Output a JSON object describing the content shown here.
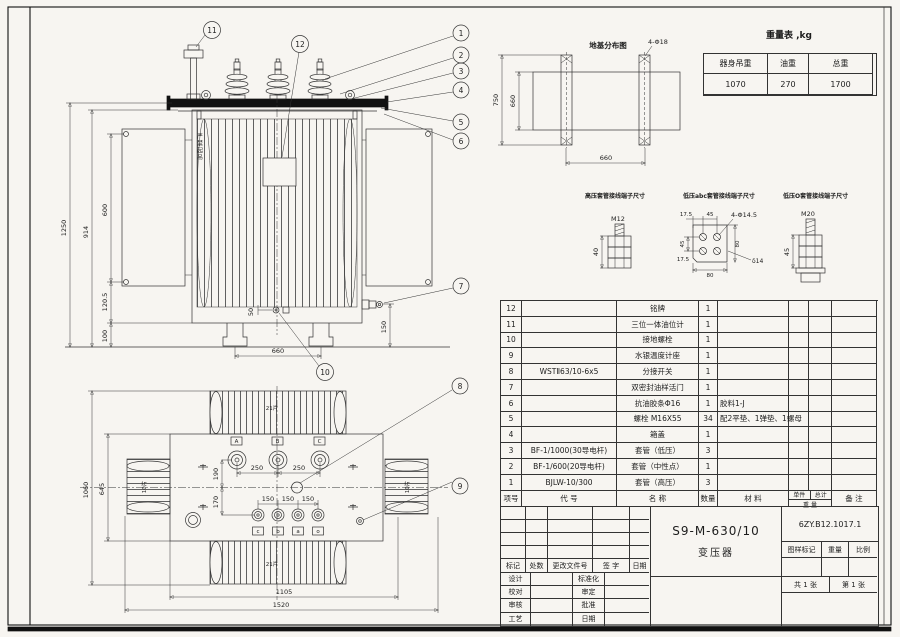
{
  "weight_table": {
    "title": "重量表 ,kg",
    "h1": "器身吊重",
    "h2": "油重",
    "h3": "总重",
    "v1": "1070",
    "v2": "270",
    "v3": "1700"
  },
  "foundation": {
    "title": "地基分布图",
    "holes_label": "4-Φ18",
    "dim_750": "750",
    "dim_660_v": "660",
    "dim_660_h": "660"
  },
  "terminals": {
    "hv_caption": "高压套管接线端子尺寸",
    "hv_thread": "M12",
    "hv_dim_40": "40",
    "lv_caption": "低压abc套管接线端子尺寸",
    "lv_holes_label": "4-Φ14.5",
    "lv_dim_17_top": "17.5",
    "lv_dim_45_top": "45",
    "lv_dim_45_left": "45",
    "lv_dim_17_bottom": "17.5",
    "lv_dim_80_right": "80",
    "lv_dim_80_bottom": "80",
    "lv_thickness": "δ14",
    "lvo_caption": "低压O套管接线端子尺寸",
    "lvo_thread": "M20",
    "lvo_dim_45": "45"
  },
  "front_view": {
    "dim_1250": "1250",
    "dim_914": "914",
    "dim_600": "600",
    "dim_120_5": "120.5",
    "dim_100": "100",
    "dim_50": "50",
    "dim_660": "660",
    "dim_150": "150",
    "warning": "严禁起吊"
  },
  "plan_view": {
    "dim_1060": "1060",
    "dim_645": "645",
    "dim_190": "190",
    "dim_170": "170",
    "dim_250_1": "250",
    "dim_250_2": "250",
    "dim_150_1": "150",
    "dim_150_2": "150",
    "dim_150_3": "150",
    "dim_1105": "1105",
    "dim_1520": "1520",
    "fins_top": "21片",
    "fins_bottom": "21片",
    "fins_left": "10片",
    "fins_right": "10片",
    "hv_marks": [
      "A",
      "B",
      "C"
    ],
    "lv_marks": [
      "c",
      "b",
      "a",
      "o"
    ]
  },
  "balloons": [
    "1",
    "2",
    "3",
    "4",
    "5",
    "6",
    "7",
    "8",
    "9",
    "10",
    "11",
    "12"
  ],
  "parts_table": {
    "headers": {
      "no": "项号",
      "code": "代  号",
      "name": "名  称",
      "qty": "数量",
      "mat": "材  料",
      "unit": "单件",
      "total": "总计",
      "weight": "重 量",
      "note": "备  注"
    },
    "rows": [
      {
        "no": "12",
        "code": "",
        "name": "铭牌",
        "qty": "1",
        "mat": ""
      },
      {
        "no": "11",
        "code": "",
        "name": "三位一体油位计",
        "qty": "1",
        "mat": ""
      },
      {
        "no": "10",
        "code": "",
        "name": "接地螺栓",
        "qty": "1",
        "mat": ""
      },
      {
        "no": "9",
        "code": "",
        "name": "水银温度计座",
        "qty": "1",
        "mat": ""
      },
      {
        "no": "8",
        "code": "WSTⅡ63/10-6x5",
        "name": "分接开关",
        "qty": "1",
        "mat": ""
      },
      {
        "no": "7",
        "code": "",
        "name": "双密封油样活门",
        "qty": "1",
        "mat": ""
      },
      {
        "no": "6",
        "code": "",
        "name": "抗油胶条Φ16",
        "qty": "1",
        "mat": "胶料1-J"
      },
      {
        "no": "5",
        "code": "",
        "name": "螺栓 M16X55",
        "qty": "34",
        "mat": "配2平垫、1弹垫、1螺母"
      },
      {
        "no": "4",
        "code": "",
        "name": "箱盖",
        "qty": "1",
        "mat": ""
      },
      {
        "no": "3",
        "code": "BF-1/1000(30导电杆)",
        "name": "套管（低压）",
        "qty": "3",
        "mat": ""
      },
      {
        "no": "2",
        "code": "BF-1/600(20导电杆)",
        "name": "套管（中性点）",
        "qty": "1",
        "mat": ""
      },
      {
        "no": "1",
        "code": "BJLW-10/300",
        "name": "套管（高压）",
        "qty": "3",
        "mat": ""
      }
    ]
  },
  "title_block": {
    "product_code": "S9-M-630/10",
    "product_name": "变压器",
    "drawing_no": "6ZY.B12.1017.1",
    "rev_headers": [
      "标记",
      "处数",
      "更改文件号",
      "签  字",
      "日期"
    ],
    "sign_rows": [
      {
        "l": "设计",
        "r": "标准化"
      },
      {
        "l": "校对",
        "r": "审定"
      },
      {
        "l": "审核",
        "r": "批准"
      },
      {
        "l": "工艺",
        "r": "日期"
      }
    ],
    "stamp_headers": [
      "图样标记",
      "重量",
      "比例"
    ],
    "sheet_total": "共 1 张",
    "sheet_no": "第 1 张"
  }
}
